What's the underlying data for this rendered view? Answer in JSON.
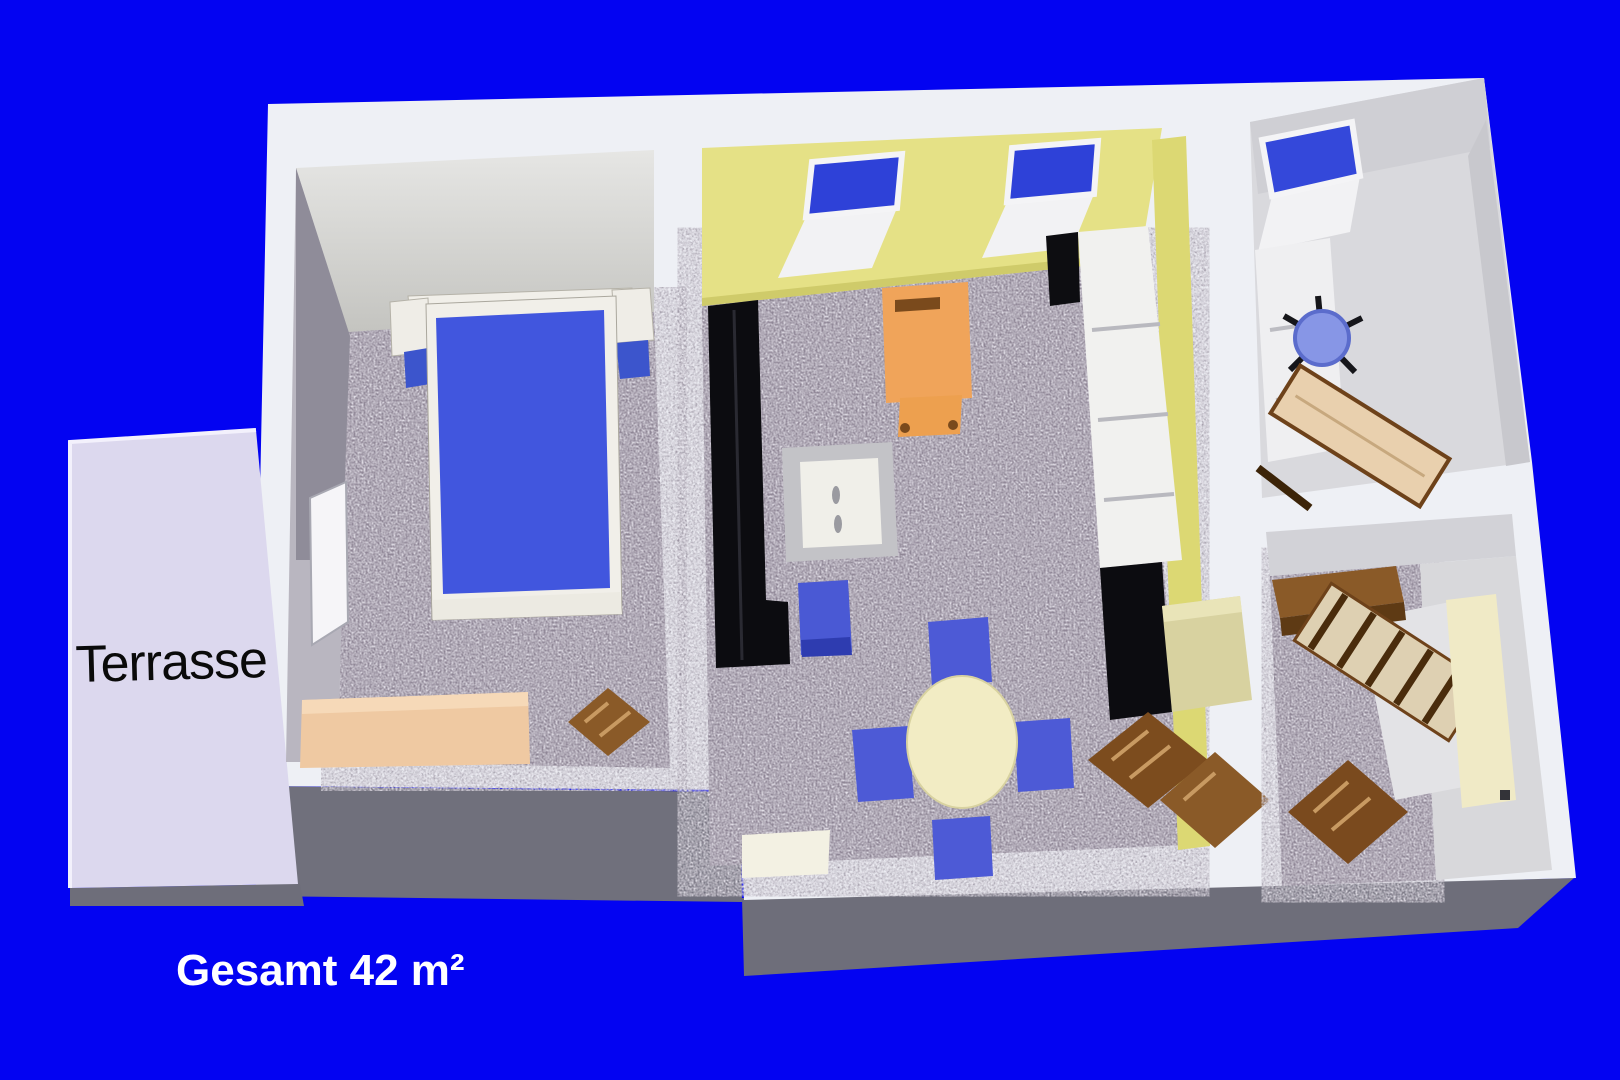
{
  "labels": {
    "terrace": "Terrasse",
    "total_area": "Gesamt 42 m²"
  },
  "palette": {
    "background_blue": "#0303f2",
    "wall_white": "#eef0f5",
    "wall_shadow_gray": "#6e6e7a",
    "inner_wall_gray": "#a09da8",
    "carpet_gray": "#8d8394",
    "wall_yellow": "#e5e186",
    "terrace_lavender": "#dcd8ee",
    "bed_blue": "#4156de",
    "window_blue": "#2e41d8",
    "chair_blue": "#4d5ad6",
    "office_chair_blue": "#8796e6",
    "armchair_orange": "#f0a45a",
    "wood_dark": "#7c4c1e",
    "wood_light": "#e9d0ae",
    "cream": "#f0eac6",
    "furniture_black": "#0c0c10",
    "dining_table_cream": "#f2ecc4",
    "right_floor_light": "#d9d9dd"
  }
}
